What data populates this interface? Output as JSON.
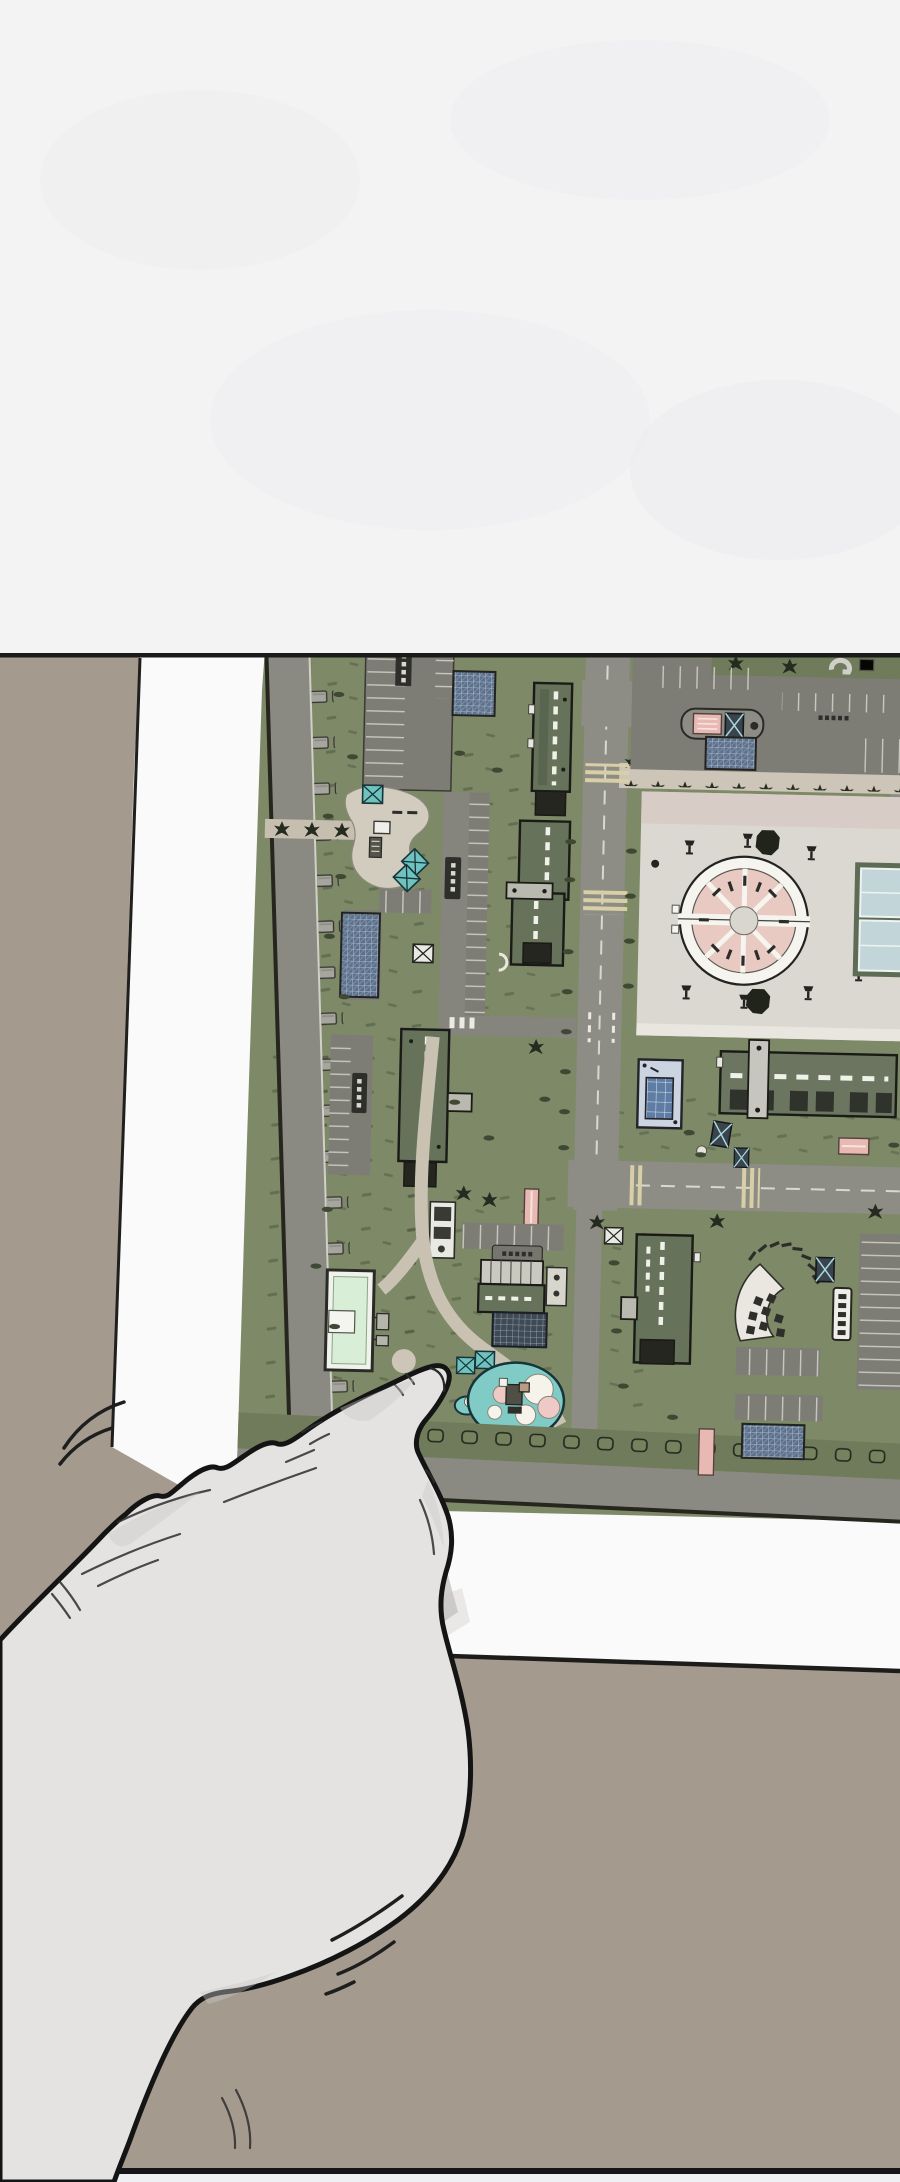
{
  "scene": {
    "type": "webtoon comic panel",
    "aria": "Comic panel: a large hand points with its index finger at a printed aerial site plan of an apartment complex lying on a table",
    "top_panel_aria": "blank white upper comic panel",
    "floor_aria": "taupe table surface background",
    "paper_aria": "white sheet of paper with printed site plan",
    "map_aria": "aerial site plan of a residential complex: apartment buildings, roads, parking lots, central plaza with circular pavilion, sports courts, playground, pool building",
    "hand_aria": "hand pointing with index finger at the playground and pool building area of the map",
    "shadow_aria": "finger shadow cast on the paper",
    "motion_aria": "comic motion lines near the moving hand"
  },
  "map": {
    "legible_text": false,
    "tiny_label_marks": 7,
    "features": {
      "perimeter_road": "tree-lined perimeter road with parked cars",
      "central_road": "main north-south road with dashed center line",
      "cross_road": "east-west road with crosswalks",
      "promenade": "tree-lined pedestrian promenade",
      "plaza": "large paved central plaza",
      "pavilion": "circular pavilion split in two halves with pink radial segments",
      "courts": "two light-blue sports courts",
      "apartment_buildings": 7,
      "parking_lots": 8,
      "bike_canopies_hatched": 5,
      "playground": "teal playground blob with play equipment",
      "pool_building": "light-green building with white rim",
      "fan_seating": "fan shaped seating terrace with tables",
      "crosswalks": 4,
      "lamp_posts": 9,
      "pink_benches": 6
    }
  },
  "palette": {
    "panel_white": "#f3f3f4",
    "panel_line": "#1a1a18",
    "floor_taupe": "#a49b8e",
    "paper_white": "#fafafa",
    "map_lawn": "#7e8968",
    "map_road": "#8c8c84",
    "map_asphalt": "#7d7d76",
    "path_tan": "#cdc6b8",
    "plaza_gray": "#dbd8d1",
    "plaza_pink_walk": "#d6cbc4",
    "roof_green": "#67725a",
    "window_dash": "#f0f1e8",
    "pink_feature": "#e7b9b2",
    "teal_play": "#80cbc5",
    "teal_box": "#6ec3be",
    "glass_blue": "#5f7da4",
    "hatch_blue": "#5d7089",
    "court_blue": "#c2d6da",
    "pavilion_pink": "#e9cac2",
    "tree_dark": "#262b20",
    "hand_skin": "#e4e3e2",
    "hand_outline": "#141414",
    "shadow_gray": "#b3b2b0",
    "zebra_tan": "#d9cfa6"
  }
}
